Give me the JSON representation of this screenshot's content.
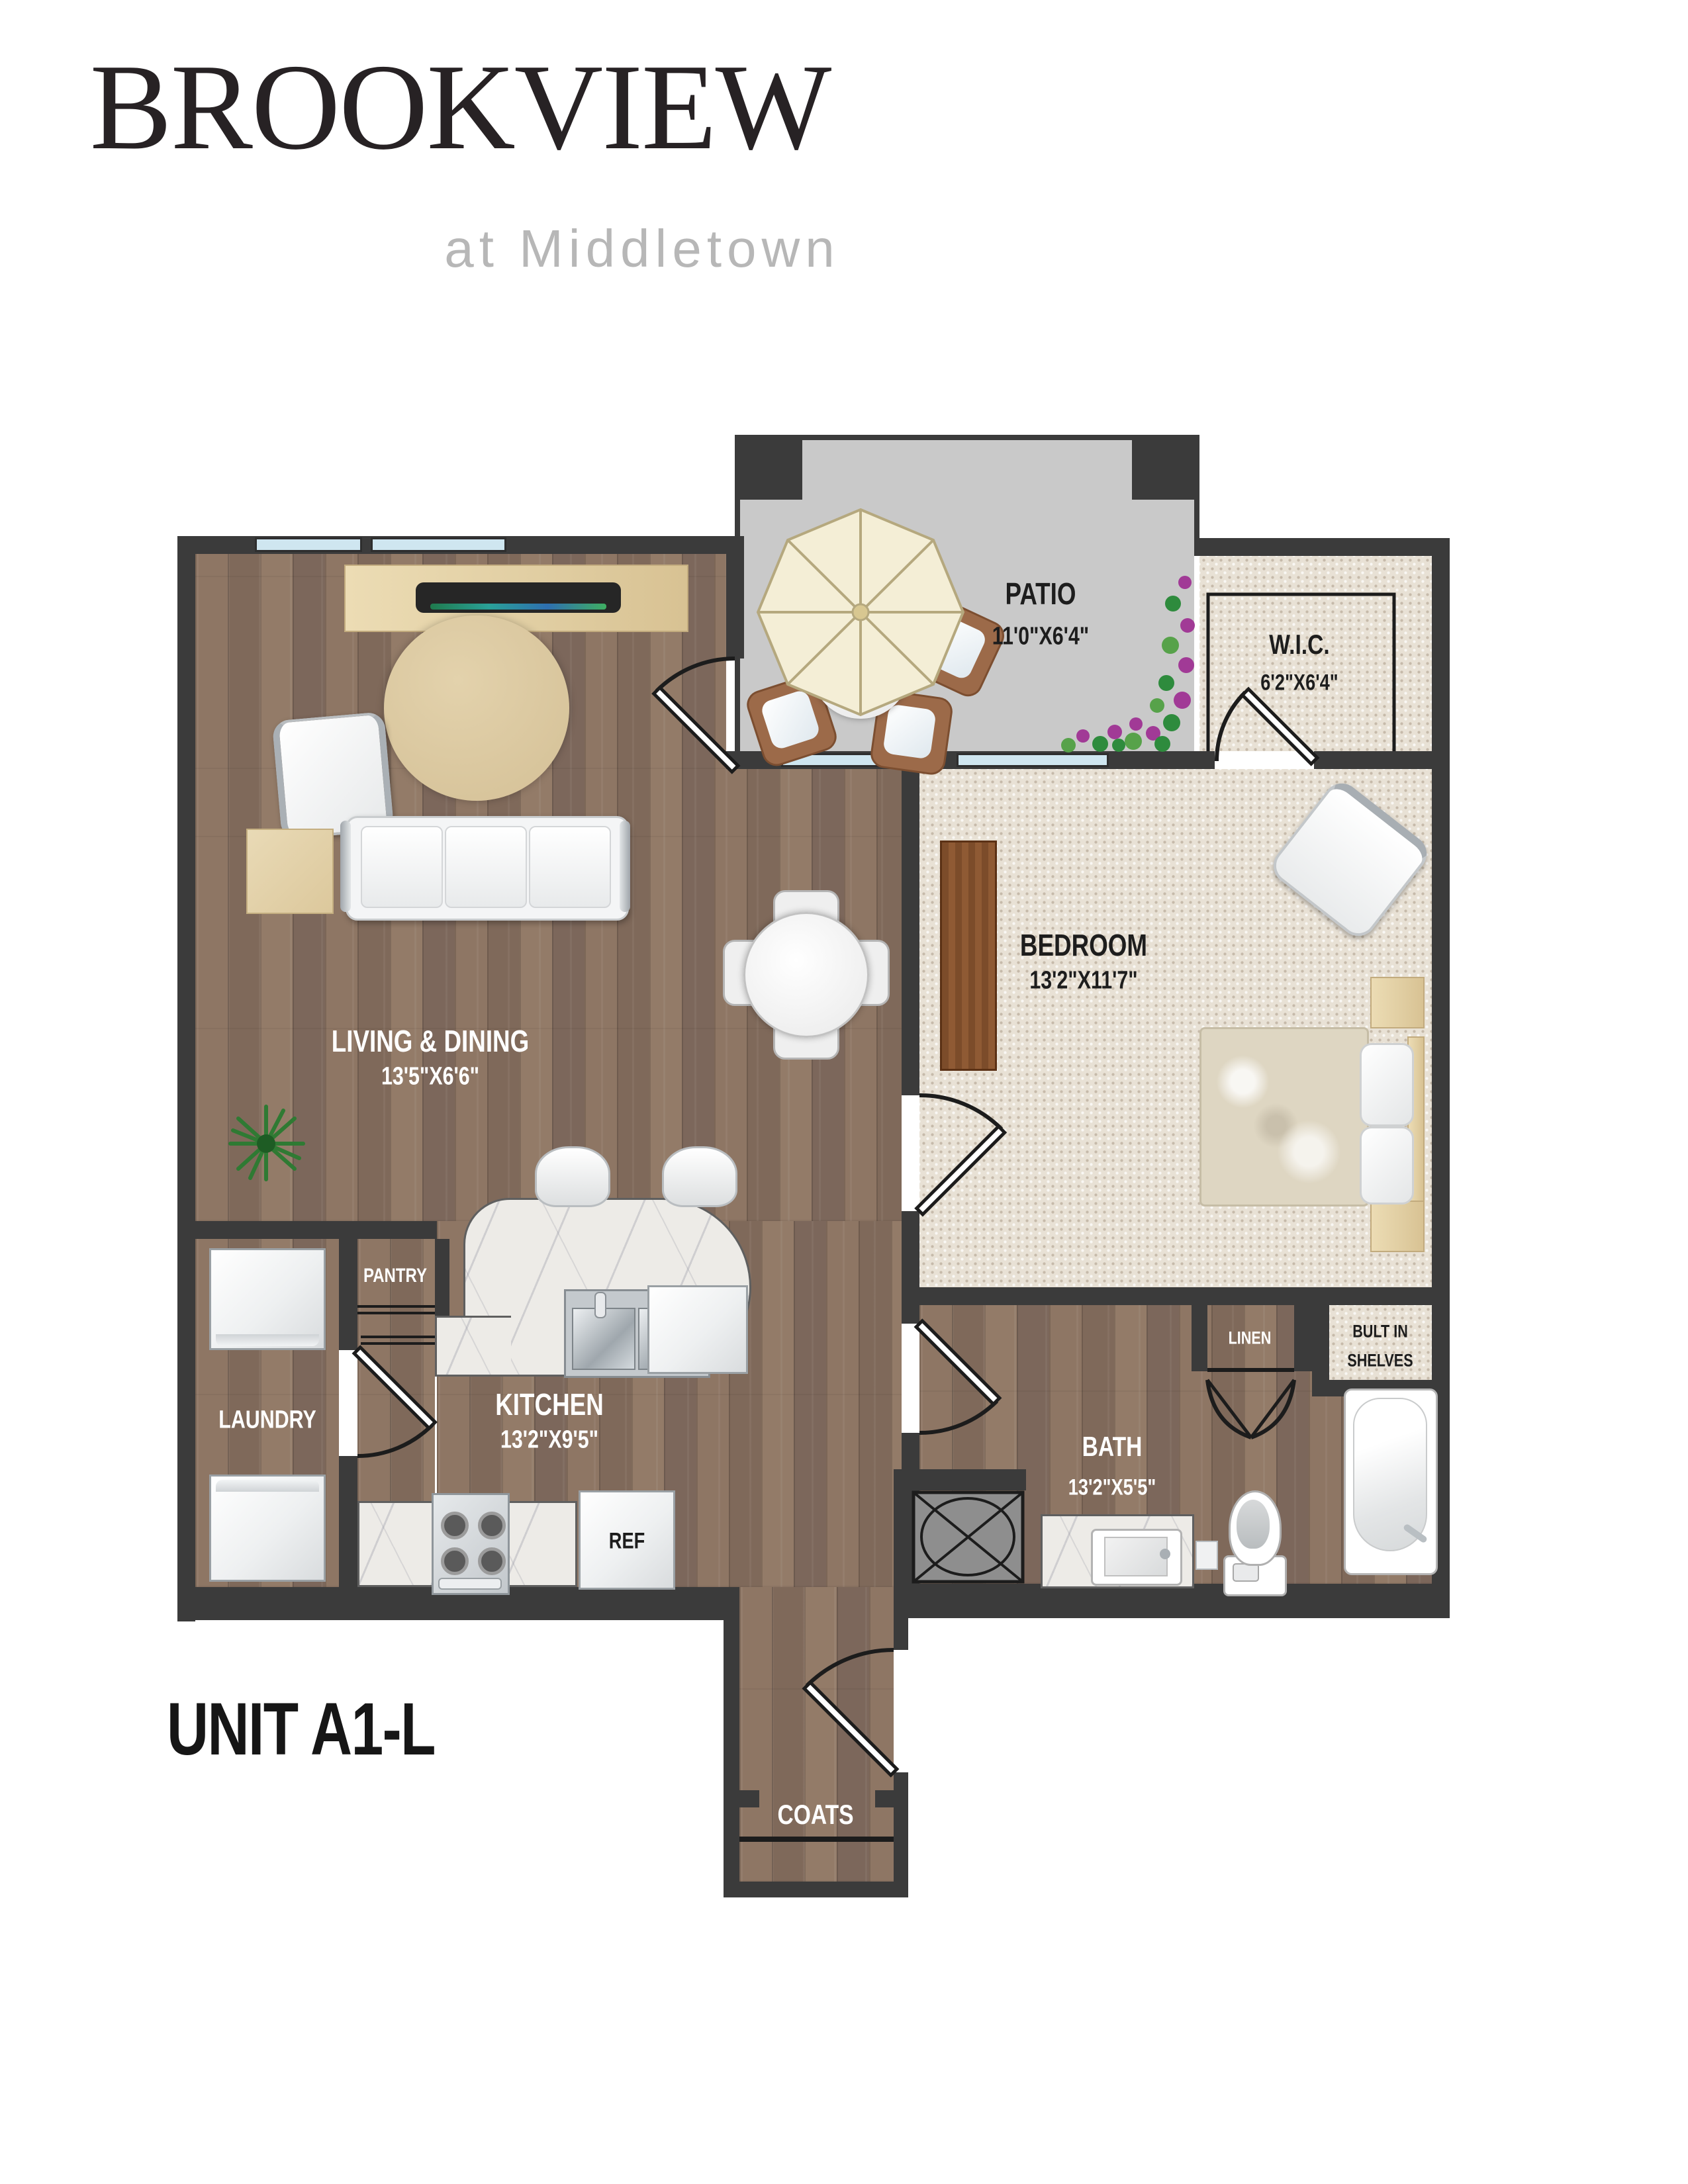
{
  "brand": {
    "name": "BROOKVIEW",
    "tagline": "at Middletown"
  },
  "unit_label": "UNIT A1-L",
  "rooms": {
    "patio": {
      "name": "PATIO",
      "dims": "11'0\"X6'4\""
    },
    "wic": {
      "name": "W.I.C.",
      "dims": "6'2\"X6'4\""
    },
    "bedroom": {
      "name": "BEDROOM",
      "dims": "13'2\"X11'7\""
    },
    "living": {
      "name": "LIVING & DINING",
      "dims": "13'5\"X6'6\""
    },
    "kitchen": {
      "name": "KITCHEN",
      "dims": "13'2\"X9'5\""
    },
    "bath": {
      "name": "BATH",
      "dims": "13'2\"X5'5\""
    },
    "laundry": {
      "name": "LAUNDRY"
    },
    "pantry": {
      "name": "PANTRY"
    },
    "linen": {
      "name": "LINEN"
    },
    "built_in": {
      "line1": "BULT IN",
      "line2": "SHELVES"
    },
    "coats": {
      "name": "COATS"
    }
  },
  "appliances": {
    "refrigerator": "REF"
  },
  "colors": {
    "wall": "#3b3b3b",
    "wood": "#8a7260",
    "carpet": "#e8e1d5",
    "patio_floor": "#c9c9c9",
    "window": "#cfe6f0",
    "logo": "#272224",
    "tagline": "#b7b7b7"
  }
}
